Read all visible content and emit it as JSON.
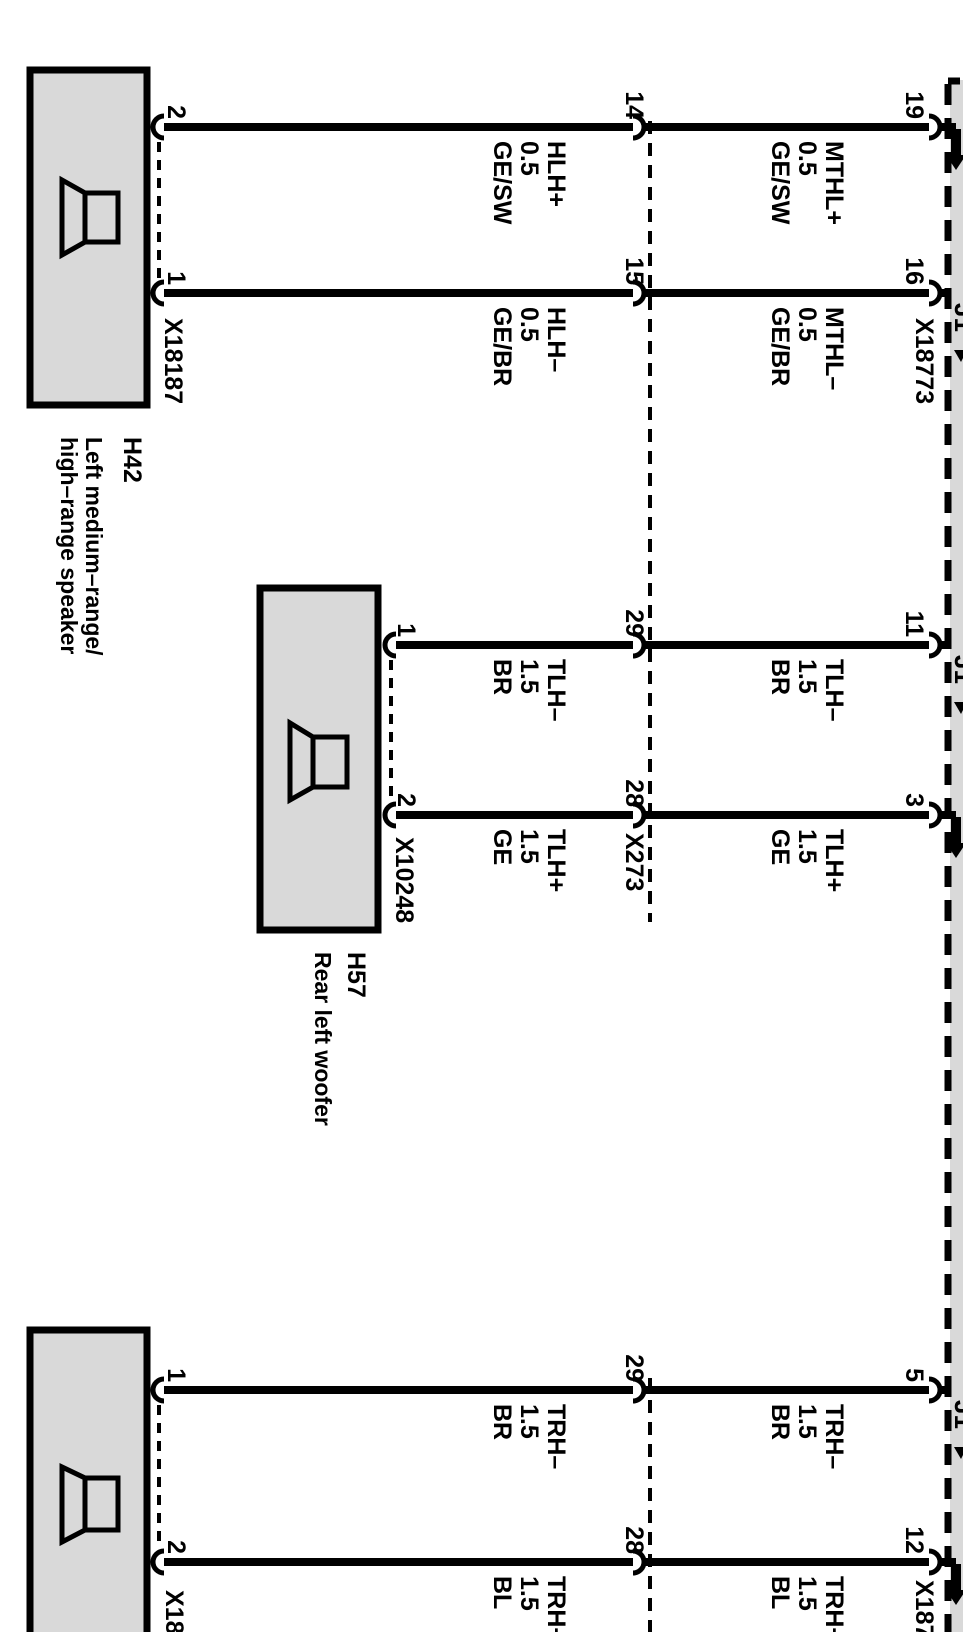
{
  "diagram_type": "automotive-wiring-diagram",
  "colors": {
    "component_fill": "#d9d9d9",
    "line": "#000000",
    "background": "#ffffff"
  },
  "speakers": [
    {
      "id": "H42",
      "desc1": "Left medium–range/",
      "desc2": "high–range speaker",
      "connector": "X18187",
      "pin_top": "2",
      "pin_bottom": "1"
    },
    {
      "id": "H57",
      "desc1": "Rear left woofer",
      "connector": "X10248",
      "pin_top": "1",
      "pin_bottom": "2"
    },
    {
      "connector": "X181",
      "pin_top": "1",
      "pin_bottom": "2"
    }
  ],
  "inline_connector": {
    "id": "X273"
  },
  "amplifier": {
    "connector_top": "X18773",
    "connector_bottom": "X187",
    "internal_fragment": "J1"
  },
  "wires": [
    {
      "speaker_pin": "2",
      "inline_pin": "14",
      "amp_pin": "19",
      "before": [
        "HLH+",
        "0.5",
        "GE/SW"
      ],
      "after": [
        "MTHL+",
        "0.5",
        "GE/SW"
      ]
    },
    {
      "speaker_pin": "1",
      "inline_pin": "15",
      "amp_pin": "16",
      "before": [
        "HLH–",
        "0.5",
        "GE/BR"
      ],
      "after": [
        "MTHL–",
        "0.5",
        "GE/BR"
      ]
    },
    {
      "speaker_pin": "1",
      "inline_pin": "29",
      "amp_pin": "11",
      "before": [
        "TLH–",
        "1.5",
        "BR"
      ],
      "after": [
        "TLH–",
        "1.5",
        "BR"
      ]
    },
    {
      "speaker_pin": "2",
      "inline_pin": "28",
      "amp_pin": "3",
      "before": [
        "TLH+",
        "1.5",
        "GE"
      ],
      "after": [
        "TLH+",
        "1.5",
        "GE"
      ]
    },
    {
      "speaker_pin": "1",
      "inline_pin": "29",
      "amp_pin": "5",
      "before": [
        "TRH–",
        "1.5",
        "BR"
      ],
      "after": [
        "TRH–",
        "1.5",
        "BR"
      ]
    },
    {
      "speaker_pin": "2",
      "inline_pin": "28",
      "amp_pin": "12",
      "before": [
        "TRH+",
        "1.5",
        "BL"
      ],
      "after": [
        "TRH+",
        "1.5",
        "BL"
      ]
    }
  ]
}
